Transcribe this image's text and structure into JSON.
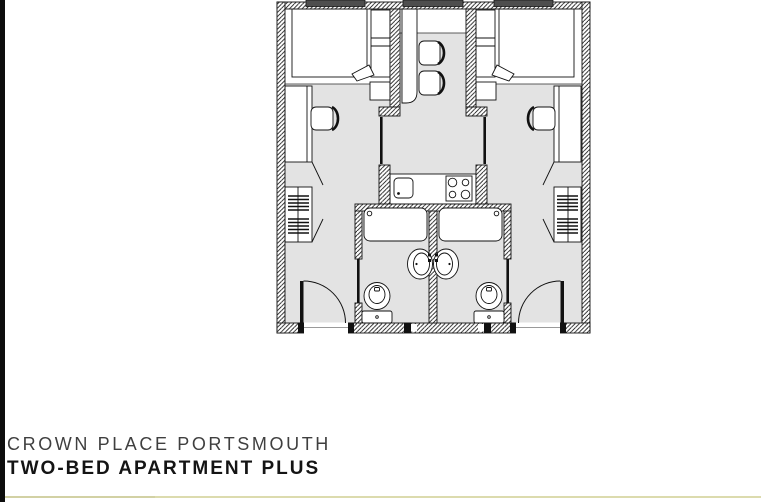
{
  "caption": {
    "property_name": "CROWN PLACE PORTSMOUTH",
    "unit_type": "TWO-BED APARTMENT PLUS"
  },
  "colors": {
    "edge_bar": "#0d0d0d",
    "floor": "#e3e3e3",
    "wall_line": "#111111",
    "window_frame": "#4e4e4e",
    "divider_line": "#dcdbae",
    "text_primary": "#141414",
    "text_secondary": "#3f3f3f"
  },
  "floor_plan": {
    "type": "apartment-floor-plan",
    "rooms": [
      {
        "name": "bedroom-1",
        "fixtures": [
          "double-bed",
          "bedside-shelf-unit",
          "desk",
          "desk-chair",
          "wardrobe-with-shelves",
          "window"
        ]
      },
      {
        "name": "bedroom-2",
        "fixtures": [
          "double-bed",
          "bedside-shelf-unit",
          "desk",
          "desk-chair",
          "wardrobe-with-shelves",
          "window"
        ]
      },
      {
        "name": "kitchen-dining",
        "fixtures": [
          "dining-table",
          "dining-chair",
          "dining-chair",
          "worktop",
          "kitchen-sink",
          "four-ring-hob",
          "window"
        ]
      },
      {
        "name": "shower-room-1",
        "fixtures": [
          "bath-shower-tray",
          "washbasin",
          "toilet",
          "door"
        ]
      },
      {
        "name": "shower-room-2",
        "fixtures": [
          "bath-shower-tray",
          "washbasin",
          "toilet",
          "door"
        ]
      },
      {
        "name": "hallway",
        "fixtures": [
          "entry-door",
          "entry-door"
        ]
      }
    ]
  }
}
